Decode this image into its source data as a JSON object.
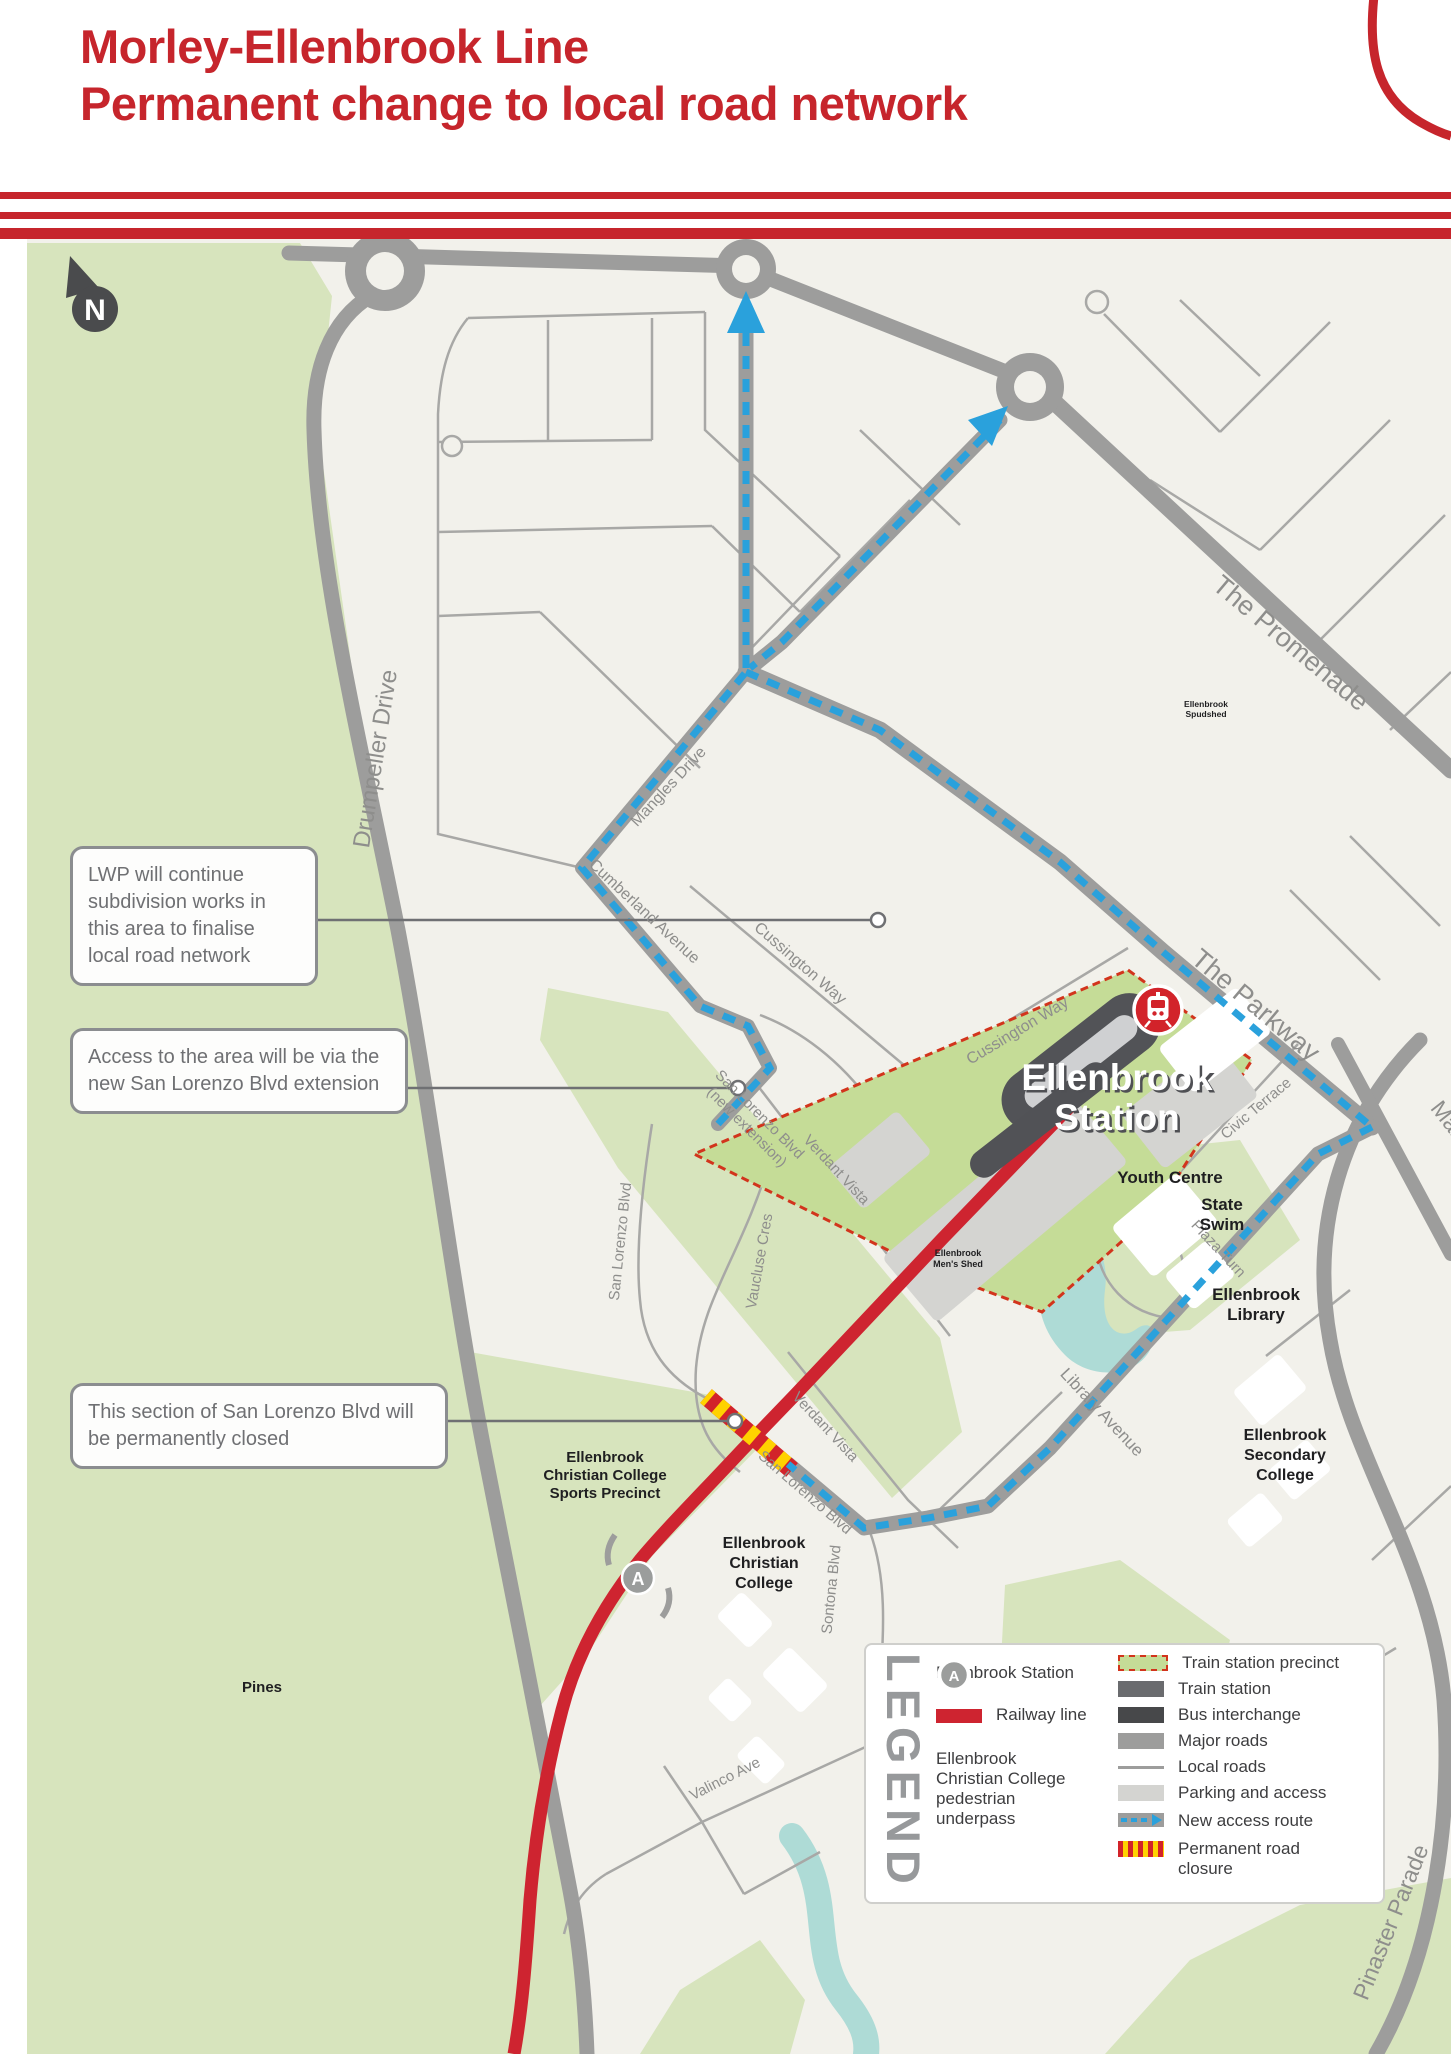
{
  "header": {
    "title_line1": "Morley-Ellenbrook Line",
    "title_line2": "Permanent change to local road network"
  },
  "north": {
    "letter": "N"
  },
  "callouts": {
    "lwp": "LWP will continue subdivision works in this area to finalise local road network",
    "access": "Access to the area will be via the new San Lorenzo Blvd extension",
    "closure": "This section of San Lorenzo Blvd will be permanently closed"
  },
  "map": {
    "station_name_l1": "Ellenbrook",
    "station_name_l2": "Station",
    "roads": {
      "drumpeller": "Drumpeller Drive",
      "promenade": "The Promenade",
      "parkway": "The Parkway",
      "main": "Main",
      "mangles": "Mangles Drive",
      "cumberland": "Cumberland Avenue",
      "cussington_a": "Cussington Way",
      "cussington_b": "Cussington Way",
      "san_lorenzo_w": "San Lorenzo Blvd",
      "san_lorenzo_ext_l1": "San Lorenzo Blvd",
      "san_lorenzo_ext_l2": "(new extension)",
      "san_lorenzo_s": "San Lorenzo Blvd",
      "vaucluse": "Vaucluse Cres",
      "verdant_a": "Verdant Vista",
      "verdant_b": "Verdant Vista",
      "library_ave": "Library Avenue",
      "plaza": "Plaza Turn",
      "civic": "Civic Terrace",
      "sontona": "Sontona Blvd",
      "valinco": "Valinco Ave",
      "pinaster": "Pinaster Parade"
    },
    "places": {
      "youth": "Youth Centre",
      "swim_l1": "State",
      "swim_l2": "Swim",
      "library_l1": "Ellenbrook",
      "library_l2": "Library",
      "secondary_l1": "Ellenbrook",
      "secondary_l2": "Secondary",
      "secondary_l3": "College",
      "christian_l1": "Ellenbrook",
      "christian_l2": "Christian",
      "christian_l3": "College",
      "sports_l1": "Ellenbrook",
      "sports_l2": "Christian College",
      "sports_l3": "Sports Precinct",
      "pines": "Pines",
      "shed_l1": "Ellenbrook",
      "shed_l2": "Men's Shed",
      "spud_l1": "Ellenbrook",
      "spud_l2": "Spudshed",
      "underpass_letter": "A"
    }
  },
  "legend": {
    "title": "LEGEND",
    "station": "Ellenbrook Station",
    "railway": "Railway line",
    "underpass_l1": "Ellenbrook",
    "underpass_l2": "Christian College",
    "underpass_l3": "pedestrian",
    "underpass_l4": "underpass",
    "underpass_letter": "A",
    "precinct": "Train station precinct",
    "train_station": "Train station",
    "bus": "Bus interchange",
    "major": "Major roads",
    "local": "Local roads",
    "parking": "Parking and access",
    "new_access": "New access route",
    "closure_l1": "Permanent road",
    "closure_l2": "closure"
  },
  "colors": {
    "brand_red": "#c6252c",
    "railway_red": "#ce2430",
    "access_blue": "#2aa1dc",
    "closure_yellow": "#ffd200",
    "precinct_green": "#c5dc97",
    "parkland_green": "#d7e4bd",
    "major_road_gray": "#9d9d9c",
    "water_teal": "#aedbd6"
  }
}
